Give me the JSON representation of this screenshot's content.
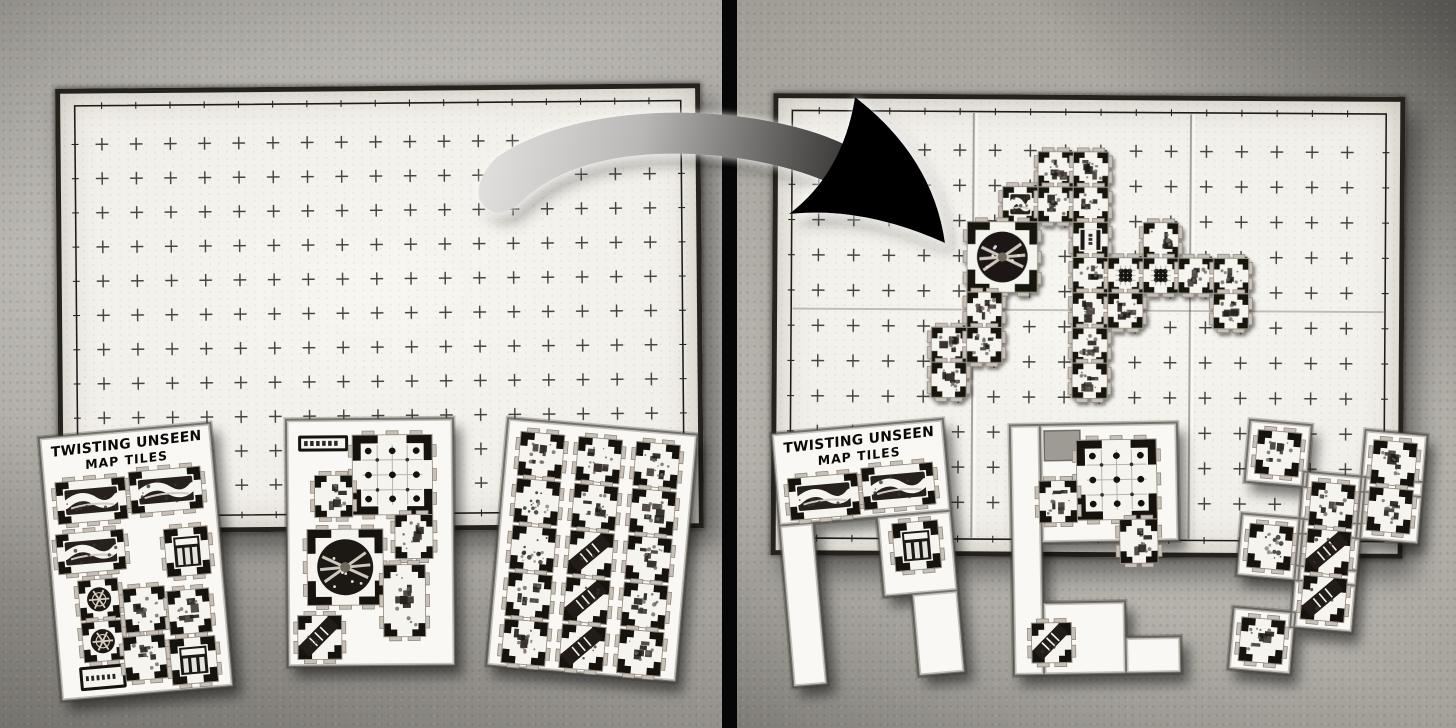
{
  "scene": {
    "width": 1456,
    "height": 728
  },
  "sheet_title": {
    "line1": "TWISTING UNSEEN",
    "line2": "MAP TILES"
  },
  "colors": {
    "table_left": "#a6a39d",
    "table_right": "#a19e97",
    "divider": "#060606",
    "map_paper": "#f2f0ea",
    "map_edge": "#25221e",
    "sheet_paper": "#faf8f4",
    "tile_ink": "#16130f",
    "tile_tab": "#c6c0b6",
    "grid_cross": "#2e2c29",
    "arrow_light": "#e2e1df",
    "arrow_dark": "#000000"
  },
  "left_panel": {
    "map": {
      "x": 57,
      "y": 86,
      "w": 645,
      "h": 445,
      "grid": 35,
      "rot": -0.5
    },
    "sheets": [
      {
        "id": "sheetL1",
        "x": 50,
        "y": 430,
        "w": 172,
        "h": 264,
        "rot": -5,
        "title": true,
        "patches": [
          [
            0,
            0,
            172,
            264
          ]
        ],
        "tiles": [
          {
            "x": 12,
            "y": 46,
            "w": 70,
            "h": 42,
            "t": "cave"
          },
          {
            "x": 86,
            "y": 42,
            "w": 72,
            "h": 42,
            "t": "cave"
          },
          {
            "x": 8,
            "y": 98,
            "w": 68,
            "h": 40,
            "t": "cave"
          },
          {
            "x": 116,
            "y": 102,
            "w": 44,
            "h": 48,
            "t": "doorway"
          },
          {
            "x": 26,
            "y": 146,
            "w": 40,
            "h": 40,
            "t": "circleS"
          },
          {
            "x": 26,
            "y": 188,
            "w": 40,
            "h": 40,
            "t": "circleS"
          },
          {
            "x": 70,
            "y": 158,
            "w": 42,
            "h": 44,
            "t": "room"
          },
          {
            "x": 114,
            "y": 164,
            "w": 42,
            "h": 44,
            "t": "room"
          },
          {
            "x": 20,
            "y": 232,
            "w": 46,
            "h": 24,
            "t": "corridor"
          },
          {
            "x": 66,
            "y": 206,
            "w": 42,
            "h": 44,
            "t": "room"
          },
          {
            "x": 112,
            "y": 212,
            "w": 46,
            "h": 46,
            "t": "doorway"
          }
        ]
      },
      {
        "id": "sheetL2",
        "x": 287,
        "y": 419,
        "w": 167,
        "h": 247,
        "rot": -0.5,
        "patches": [
          [
            0,
            0,
            167,
            247
          ]
        ],
        "tiles": [
          {
            "x": 12,
            "y": 16,
            "w": 50,
            "h": 16,
            "t": "corridor"
          },
          {
            "x": 66,
            "y": 16,
            "w": 80,
            "h": 80,
            "t": "pillars"
          },
          {
            "x": 28,
            "y": 56,
            "w": 38,
            "h": 42,
            "t": "room"
          },
          {
            "x": 108,
            "y": 96,
            "w": 38,
            "h": 44,
            "t": "room"
          },
          {
            "x": 20,
            "y": 110,
            "w": 76,
            "h": 76,
            "t": "circle"
          },
          {
            "x": 96,
            "y": 146,
            "w": 42,
            "h": 72,
            "t": "room2"
          },
          {
            "x": 10,
            "y": 196,
            "w": 44,
            "h": 44,
            "t": "diagonal"
          }
        ]
      },
      {
        "id": "sheetL3",
        "x": 497,
        "y": 426,
        "w": 190,
        "h": 248,
        "rot": 5,
        "patches": [
          [
            0,
            0,
            190,
            248
          ]
        ],
        "grid": {
          "ox": 14,
          "oy": 12,
          "cell": 44,
          "px": 58,
          "py": 47
        },
        "rows": [
          [
            "room",
            "room",
            "room"
          ],
          [
            "rubble",
            "room",
            "room"
          ],
          [
            "rubble",
            "diagonal",
            "room"
          ],
          [
            "room",
            "diagonal",
            "room"
          ],
          [
            "room",
            "diagonal",
            "room"
          ]
        ]
      }
    ]
  },
  "right_panel": {
    "map": {
      "x": 772,
      "y": 95,
      "w": 632,
      "h": 462,
      "grid": 36,
      "rot": 0.35,
      "creases": {
        "vertical": [
          198,
          420
        ],
        "horizontal": [
          215
        ]
      }
    },
    "dungeon": {
      "ox": 928,
      "oy": 148,
      "cell": 36,
      "cells": [
        [
          3,
          0,
          "room"
        ],
        [
          4,
          0,
          "room"
        ],
        [
          2,
          1,
          "cave"
        ],
        [
          3,
          1,
          "room"
        ],
        [
          4,
          1,
          "room"
        ],
        [
          1,
          2,
          "circle2"
        ],
        [
          4,
          2,
          "corr"
        ],
        [
          6,
          2,
          "room"
        ],
        [
          4,
          3,
          "room"
        ],
        [
          5,
          3,
          "pillars"
        ],
        [
          6,
          3,
          "pillars"
        ],
        [
          7,
          3,
          "room"
        ],
        [
          8,
          3,
          "room"
        ],
        [
          1,
          4,
          "room"
        ],
        [
          4,
          4,
          "room"
        ],
        [
          5,
          4,
          "room"
        ],
        [
          8,
          4,
          "room2"
        ],
        [
          0,
          5,
          "room"
        ],
        [
          1,
          5,
          "room"
        ],
        [
          4,
          5,
          "room"
        ],
        [
          0,
          6,
          "room"
        ],
        [
          4,
          6,
          "room"
        ]
      ]
    },
    "sheets": [
      {
        "id": "sheetR1",
        "x": 782,
        "y": 426,
        "w": 172,
        "h": 252,
        "rot": -5,
        "title": true,
        "patches": [
          [
            0,
            0,
            172,
            92
          ],
          [
            0,
            92,
            34,
            162
          ],
          [
            98,
            92,
            74,
            80
          ],
          [
            126,
            172,
            46,
            82
          ]
        ],
        "holes": [],
        "tiles": [
          {
            "x": 12,
            "y": 46,
            "w": 70,
            "h": 42,
            "t": "cave"
          },
          {
            "x": 86,
            "y": 42,
            "w": 72,
            "h": 42,
            "t": "cave"
          },
          {
            "x": 112,
            "y": 100,
            "w": 46,
            "h": 48,
            "t": "doorway"
          }
        ]
      },
      {
        "id": "sheetR2",
        "x": 1012,
        "y": 424,
        "w": 167,
        "h": 250,
        "rot": -1,
        "patches": [
          [
            0,
            0,
            30,
            250
          ],
          [
            30,
            0,
            137,
            118
          ],
          [
            30,
            178,
            82,
            72
          ],
          [
            112,
            214,
            55,
            36
          ]
        ],
        "holes": [
          [
            34,
            6,
            36,
            30
          ]
        ],
        "tiles": [
          {
            "x": 66,
            "y": 16,
            "w": 80,
            "h": 80,
            "t": "pillars"
          },
          {
            "x": 28,
            "y": 56,
            "w": 38,
            "h": 42,
            "t": "room"
          },
          {
            "x": 108,
            "y": 96,
            "w": 38,
            "h": 44,
            "t": "room"
          },
          {
            "x": 18,
            "y": 198,
            "w": 40,
            "h": 40,
            "t": "diagonal"
          }
        ]
      },
      {
        "id": "sheetR3",
        "x": 1232,
        "y": 424,
        "w": 190,
        "h": 252,
        "rot": 5,
        "grid": {
          "ox": 16,
          "oy": 12,
          "cell": 44,
          "px": 58,
          "py": 47
        },
        "pad": 9,
        "cells": [
          [
            0,
            0,
            "room"
          ],
          [
            2,
            0,
            "room"
          ],
          [
            1,
            1,
            "room"
          ],
          [
            2,
            1,
            "room"
          ],
          [
            0,
            2,
            "rubble"
          ],
          [
            1,
            2,
            "diagonal"
          ],
          [
            1,
            3,
            "diagonal"
          ],
          [
            0,
            4,
            "room"
          ]
        ]
      }
    ]
  },
  "arrow": {
    "body": "M 497,157 C 555,118 655,103 757,119 C 812,128 849,143 871,161 L 853,195 C 803,165 725,151 655,154 C 597,157 551,173 522,201 C 509,214 492,218 481,202 C 473,189 485,168 497,157 Z",
    "head": "M 855,97 Q 933,157 945,243 Q 863,206 789,214 Q 843,173 855,97 Z",
    "gradient": {
      "x1": 470,
      "y1": 150,
      "x2": 944,
      "y2": 220,
      "stops": [
        [
          0,
          "#e4e3e1"
        ],
        [
          0.35,
          "#b9b8b6"
        ],
        [
          0.68,
          "#565452"
        ],
        [
          1,
          "#000000"
        ]
      ]
    }
  }
}
